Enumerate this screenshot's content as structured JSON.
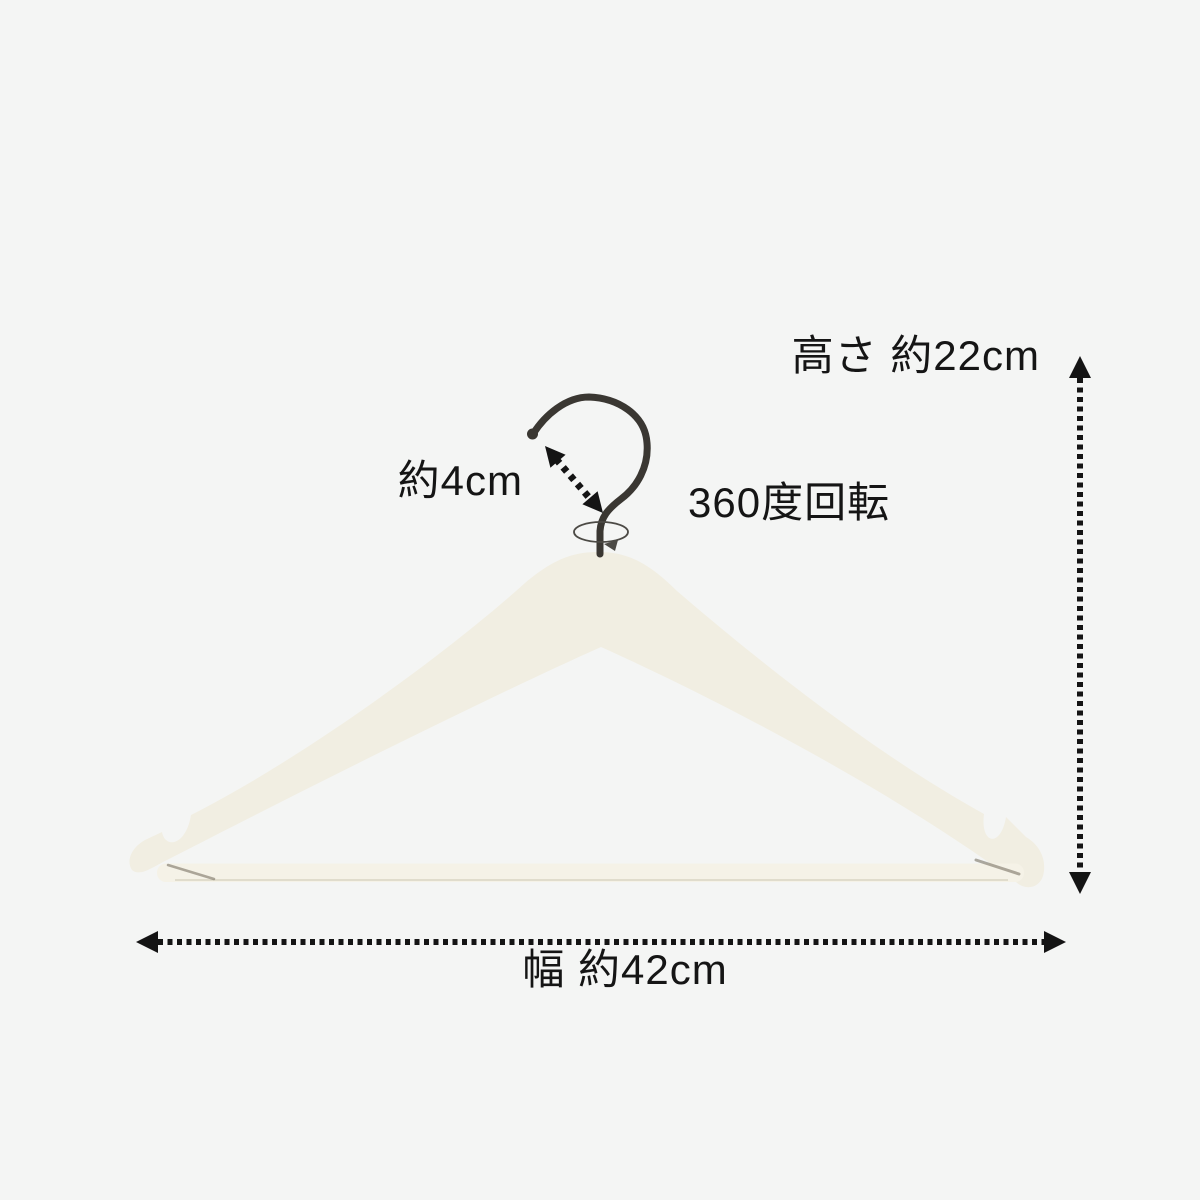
{
  "colors": {
    "background": "#f4f5f4",
    "hanger": "#f1eee2",
    "hanger_light": "#f5f2e7",
    "hanger_shade": "#ded9c9",
    "crease": "#6e6658",
    "hook": "#3a3732",
    "rotation": "#4c4a45",
    "text": "#151515",
    "arrow": "#141414"
  },
  "annotations": {
    "height_label": "高さ 約22cm",
    "hook_length_label": "約4cm",
    "rotation_label": "360度回転",
    "width_label": "幅 約42cm"
  }
}
